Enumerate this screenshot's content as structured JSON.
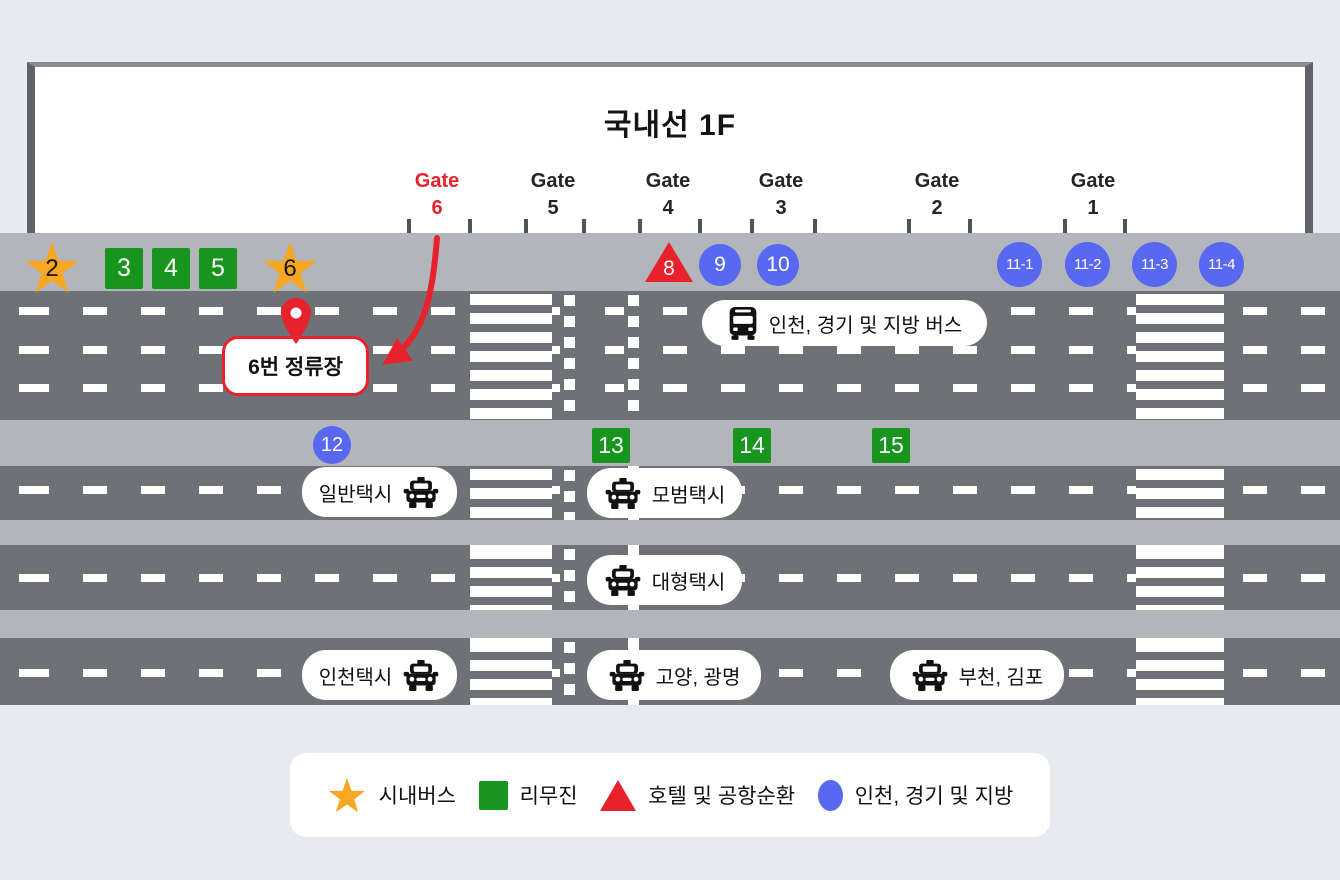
{
  "title": "국내선 1F",
  "gates": [
    {
      "word": "Gate",
      "number": "6"
    },
    {
      "word": "Gate",
      "number": "5"
    },
    {
      "word": "Gate",
      "number": "4"
    },
    {
      "word": "Gate",
      "number": "3"
    },
    {
      "word": "Gate",
      "number": "2"
    },
    {
      "word": "Gate",
      "number": "1"
    }
  ],
  "callout": {
    "stop_label": "6번 정류장"
  },
  "bus_label": "인천, 경기 및 지방 버스",
  "sidewalk_markers": [
    {
      "shape": "star",
      "label": "2"
    },
    {
      "shape": "square",
      "label": "3"
    },
    {
      "shape": "square",
      "label": "4"
    },
    {
      "shape": "square",
      "label": "5"
    },
    {
      "shape": "star",
      "label": "6"
    },
    {
      "shape": "triangle",
      "label": "8"
    },
    {
      "shape": "circle",
      "label": "9"
    },
    {
      "shape": "circle",
      "label": "10"
    },
    {
      "shape": "circle",
      "label": "11-1"
    },
    {
      "shape": "circle",
      "label": "11-2"
    },
    {
      "shape": "circle",
      "label": "11-3"
    },
    {
      "shape": "circle",
      "label": "11-4"
    }
  ],
  "island_markers": [
    {
      "shape": "circle",
      "label": "12"
    },
    {
      "shape": "square",
      "label": "13"
    },
    {
      "shape": "square",
      "label": "14"
    },
    {
      "shape": "square",
      "label": "15"
    }
  ],
  "road_labels": {
    "general_taxi": "일반택시",
    "deluxe_taxi": "모범택시",
    "large_taxi": "대형택시",
    "incheon_taxi": "인천택시",
    "goyang": "고양, 광명",
    "bucheon": "부천, 김포"
  },
  "legend": [
    {
      "shape": "star",
      "label": "시내버스"
    },
    {
      "shape": "square",
      "label": "리무진"
    },
    {
      "shape": "triangle",
      "label": "호텔 및 공항순환"
    },
    {
      "shape": "circle",
      "label": "인천, 경기 및 지방"
    }
  ],
  "colors": {
    "star_orange": "#F6A723",
    "limousine_green": "#17951C",
    "shuttle_red": "#E8222D",
    "regional_blue": "#5868F0",
    "road_gray": "#6E7176",
    "sidewalk_gray": "#B2B5BA",
    "background": "#E7EAEE"
  }
}
